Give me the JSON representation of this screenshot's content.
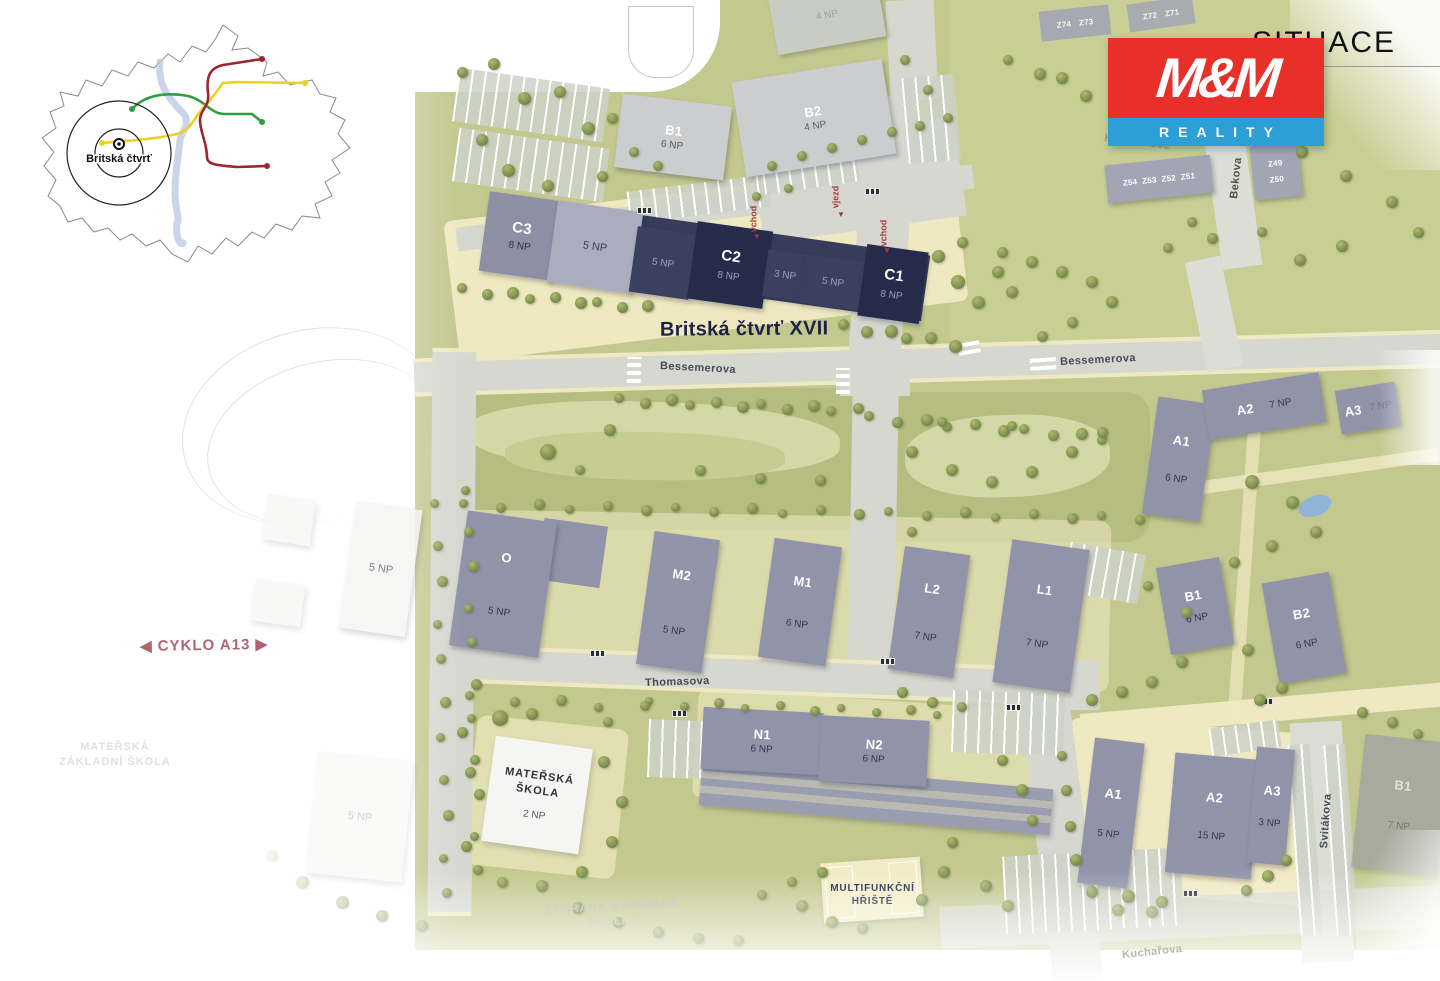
{
  "title": "SITUACE",
  "logo": {
    "mm": "M&M",
    "reality": "REALITY",
    "red": "#E8302A",
    "blue": "#2B9FD6"
  },
  "inset": {
    "label": "Britská čtvrť"
  },
  "site_label": "Britská čtvrť XVII",
  "cyklo_label": "CYKLO A13",
  "streets": {
    "bessemerova": "Bessemerova",
    "thomasova": "Thomasova",
    "svitakova": "Svitákova",
    "kucharova": "Kuchařova",
    "bekova": "Bekova",
    "hynka_puce": "Hynka Puce"
  },
  "entrances": {
    "vchod": "vchod",
    "vjezd": "vjezd"
  },
  "areas": {
    "playground": "MULTIFUNKČNÍ HŘIŠTĚ",
    "garden": "ZAHRADA MATEŘSKÉ ŠKOLKY",
    "faint_school": "MATEŘSKÁ ZÁKLADNÍ ŠKOLA"
  },
  "buildings": {
    "top_b1": {
      "code": "B1",
      "floors": "6 NP"
    },
    "top_b2": {
      "code": "B2",
      "floors": "4 NP"
    },
    "top_4np": {
      "floors": "4 NP"
    },
    "c3": {
      "code": "C3",
      "floors": "8 NP"
    },
    "c_5np_light": {
      "floors": "5 NP"
    },
    "c_5np_a": {
      "floors": "5 NP"
    },
    "c2": {
      "code": "C2",
      "floors": "8 NP"
    },
    "c_3np": {
      "floors": "3 NP"
    },
    "c_5np_b": {
      "floors": "5 NP"
    },
    "c1": {
      "code": "C1",
      "floors": "8 NP"
    },
    "o": {
      "code": "O",
      "floors": "5 NP"
    },
    "m2": {
      "code": "M2",
      "floors": "5 NP"
    },
    "m1": {
      "code": "M1",
      "floors": "6 NP"
    },
    "l2": {
      "code": "L2",
      "floors": "7 NP"
    },
    "l1": {
      "code": "L1",
      "floors": "7 NP"
    },
    "a1_ne": {
      "code": "A1",
      "floors": "6 NP"
    },
    "a2_ne": {
      "code": "A2",
      "floors": "7 NP"
    },
    "a3_ne": {
      "code": "A3",
      "floors": "7 NP"
    },
    "b1_e": {
      "code": "B1",
      "floors": "6 NP"
    },
    "b2_e": {
      "code": "B2",
      "floors": "6 NP"
    },
    "n1": {
      "code": "N1",
      "floors": "6 NP"
    },
    "n2": {
      "code": "N2",
      "floors": "6 NP"
    },
    "a1_s": {
      "code": "A1",
      "floors": "5 NP"
    },
    "a2_s": {
      "code": "A2",
      "floors": "15 NP"
    },
    "a3_s": {
      "code": "A3",
      "floors": "3 NP"
    },
    "b1_se": {
      "code": "B1",
      "floors": "7 NP"
    },
    "skola": {
      "code": "MATEŘSKÁ ŠKOLA",
      "floors": "2 NP"
    },
    "west_5np": {
      "floors": "5 NP"
    },
    "sw_5np": {
      "floors": "5 NP"
    }
  },
  "plots": {
    "z74": "Z74",
    "z73": "Z73",
    "z72": "Z72",
    "z71": "Z71",
    "z56": "Z56",
    "z55": "Z55",
    "z54": "Z54",
    "z53": "Z53",
    "z52": "Z52",
    "z51": "Z51",
    "z49": "Z49",
    "z50": "Z50"
  }
}
